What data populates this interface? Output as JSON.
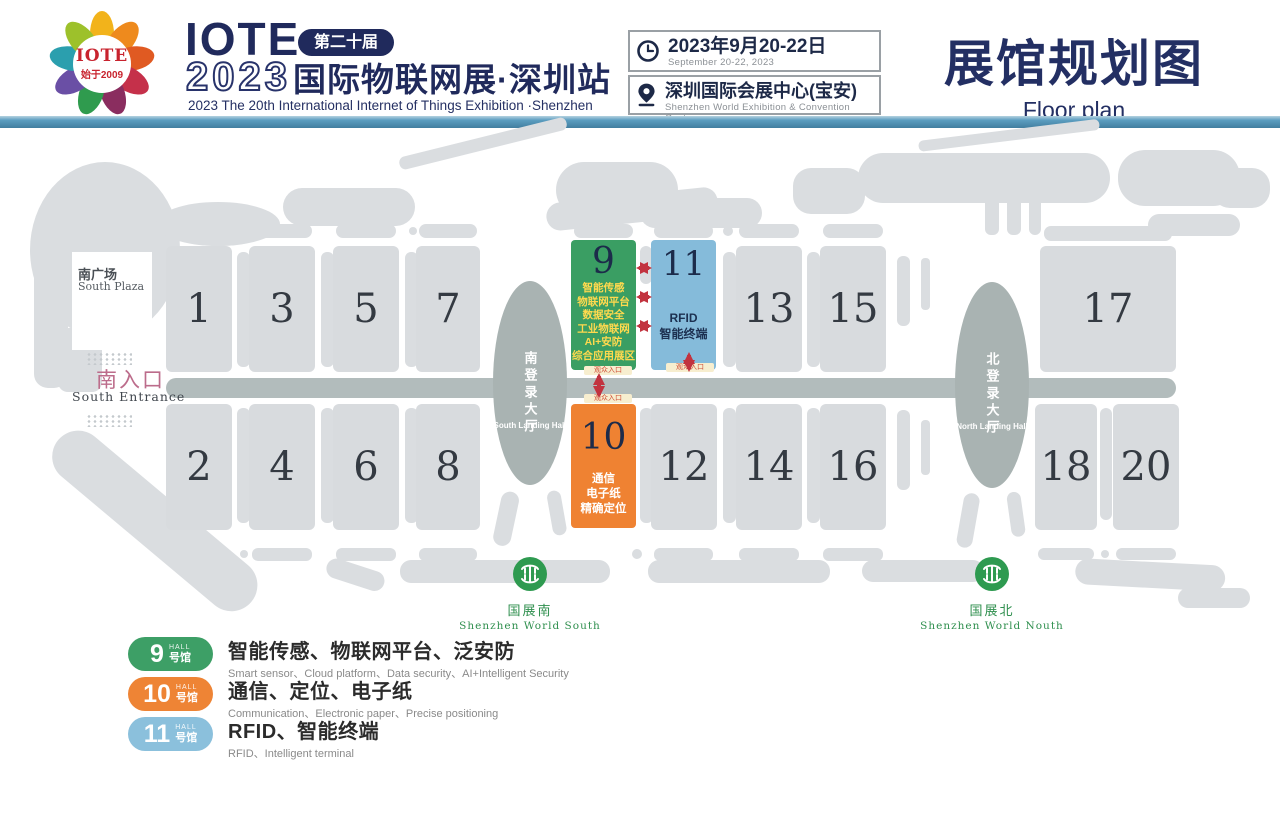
{
  "header": {
    "logo": {
      "brand": "IOTE",
      "since": "始于2009"
    },
    "brand": "IOTE",
    "edition_badge": "第二十届",
    "year": "2023",
    "title_cn": "国际物联网展·深圳站",
    "subtitle_en": "2023 The 20th  International Internet of Things Exhibition ·Shenzhen",
    "date": {
      "cn": "2023年9月20-22日",
      "en": "September 20-22, 2023"
    },
    "venue": {
      "cn": "深圳国际会展中心(宝安)",
      "en": "Shenzhen World Exhibition & Convention Center"
    },
    "page_title": {
      "cn": "展馆规划图",
      "en": "Floor plan"
    }
  },
  "map": {
    "south_plaza": {
      "cn": "南广场",
      "en": "South Plaza"
    },
    "south_entrance": {
      "cn": "南入口",
      "en": "South Entrance"
    },
    "south_landing": {
      "cn": "南登录大厅",
      "en": "South Landing Hall"
    },
    "north_landing": {
      "cn": "北登录大厅",
      "en": "North Landing Hall"
    },
    "metro_south": {
      "cn": "国展南",
      "en": "Shenzhen  World South"
    },
    "metro_north": {
      "cn": "国展北",
      "en": "Shenzhen  World Nouth"
    },
    "entrance_tag": "观众入口",
    "halls": {
      "h1": "1",
      "h2": "2",
      "h3": "3",
      "h4": "4",
      "h5": "5",
      "h6": "6",
      "h7": "7",
      "h8": "8",
      "h12": "12",
      "h13": "13",
      "h14": "14",
      "h15": "15",
      "h16": "16",
      "h17": "17",
      "h18": "18",
      "h20": "20"
    },
    "hall9": {
      "number": "9",
      "lines": [
        "智能传感",
        "物联网平台",
        "数据安全",
        "工业物联网",
        "AI+安防",
        "综合应用展区"
      ]
    },
    "hall10": {
      "number": "10",
      "lines": [
        "通信",
        "电子纸",
        "精确定位"
      ]
    },
    "hall11": {
      "number": "11",
      "lines": [
        "RFID",
        "智能终端"
      ]
    }
  },
  "legend": {
    "items": [
      {
        "number": "9",
        "hall_label": "HALL",
        "hall_cn": "号馆",
        "color": "#3d9f66",
        "title": "智能传感、物联网平台、泛安防",
        "subtitle": "Smart sensor、Cloud platform、Data security、AI+Intelligent Security"
      },
      {
        "number": "10",
        "hall_label": "HALL",
        "hall_cn": "号馆",
        "color": "#ee8435",
        "title": "通信、定位、电子纸",
        "subtitle": "Communication、Electronic paper、Precise positioning"
      },
      {
        "number": "11",
        "hall_label": "HALL",
        "hall_cn": "号馆",
        "color": "#8bc0dc",
        "title": "RFID、智能终端",
        "subtitle": "RFID、Intelligent terminal"
      }
    ]
  },
  "colors": {
    "hall9": "#3a9e63",
    "hall10": "#ef8232",
    "hall11": "#85bbda",
    "hall_gray": "#d8dbde",
    "corridor": "#b2bcbc",
    "landing": "#a9b3b2",
    "accent_navy": "#202a5c",
    "arrow_red": "#c2333f",
    "metro_green": "#2e9a50"
  }
}
